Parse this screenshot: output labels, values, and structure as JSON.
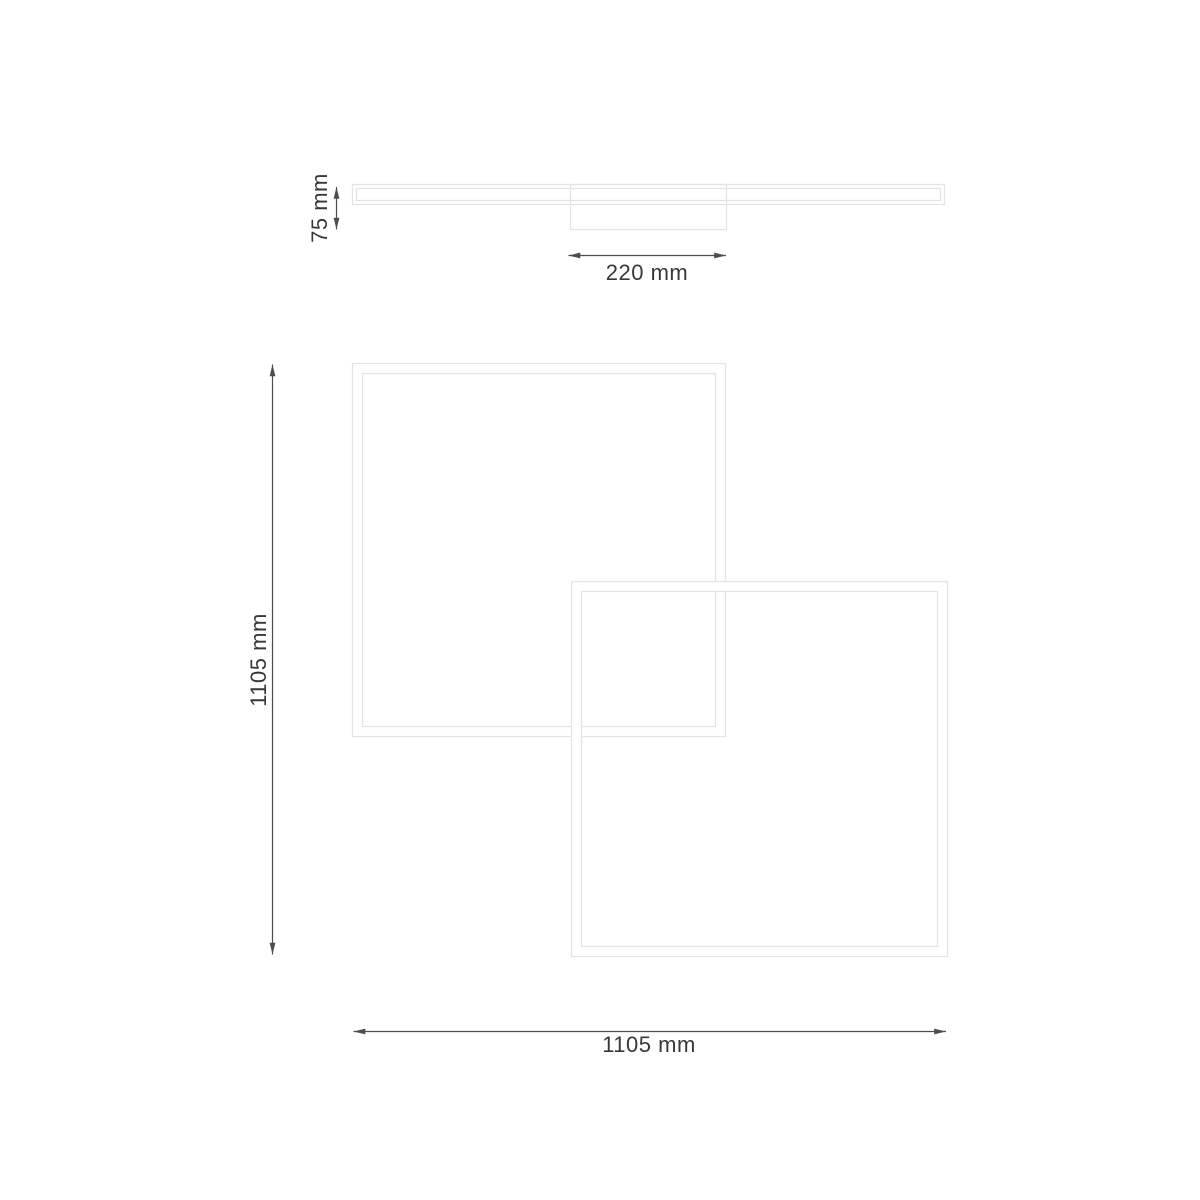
{
  "diagram": {
    "type": "technical-dimension-drawing",
    "subject": "ceiling-light-overlapping-square-frames",
    "side_view": {
      "height_label": "75 mm",
      "canopy_width_label": "220 mm"
    },
    "plan_view": {
      "height_label": "1105 mm",
      "width_label": "1105 mm"
    }
  },
  "colors": {
    "background": "#ffffff",
    "outline": "#e4e4e4",
    "dimension_line": "#4d4d4d",
    "dimension_text": "#383838"
  }
}
